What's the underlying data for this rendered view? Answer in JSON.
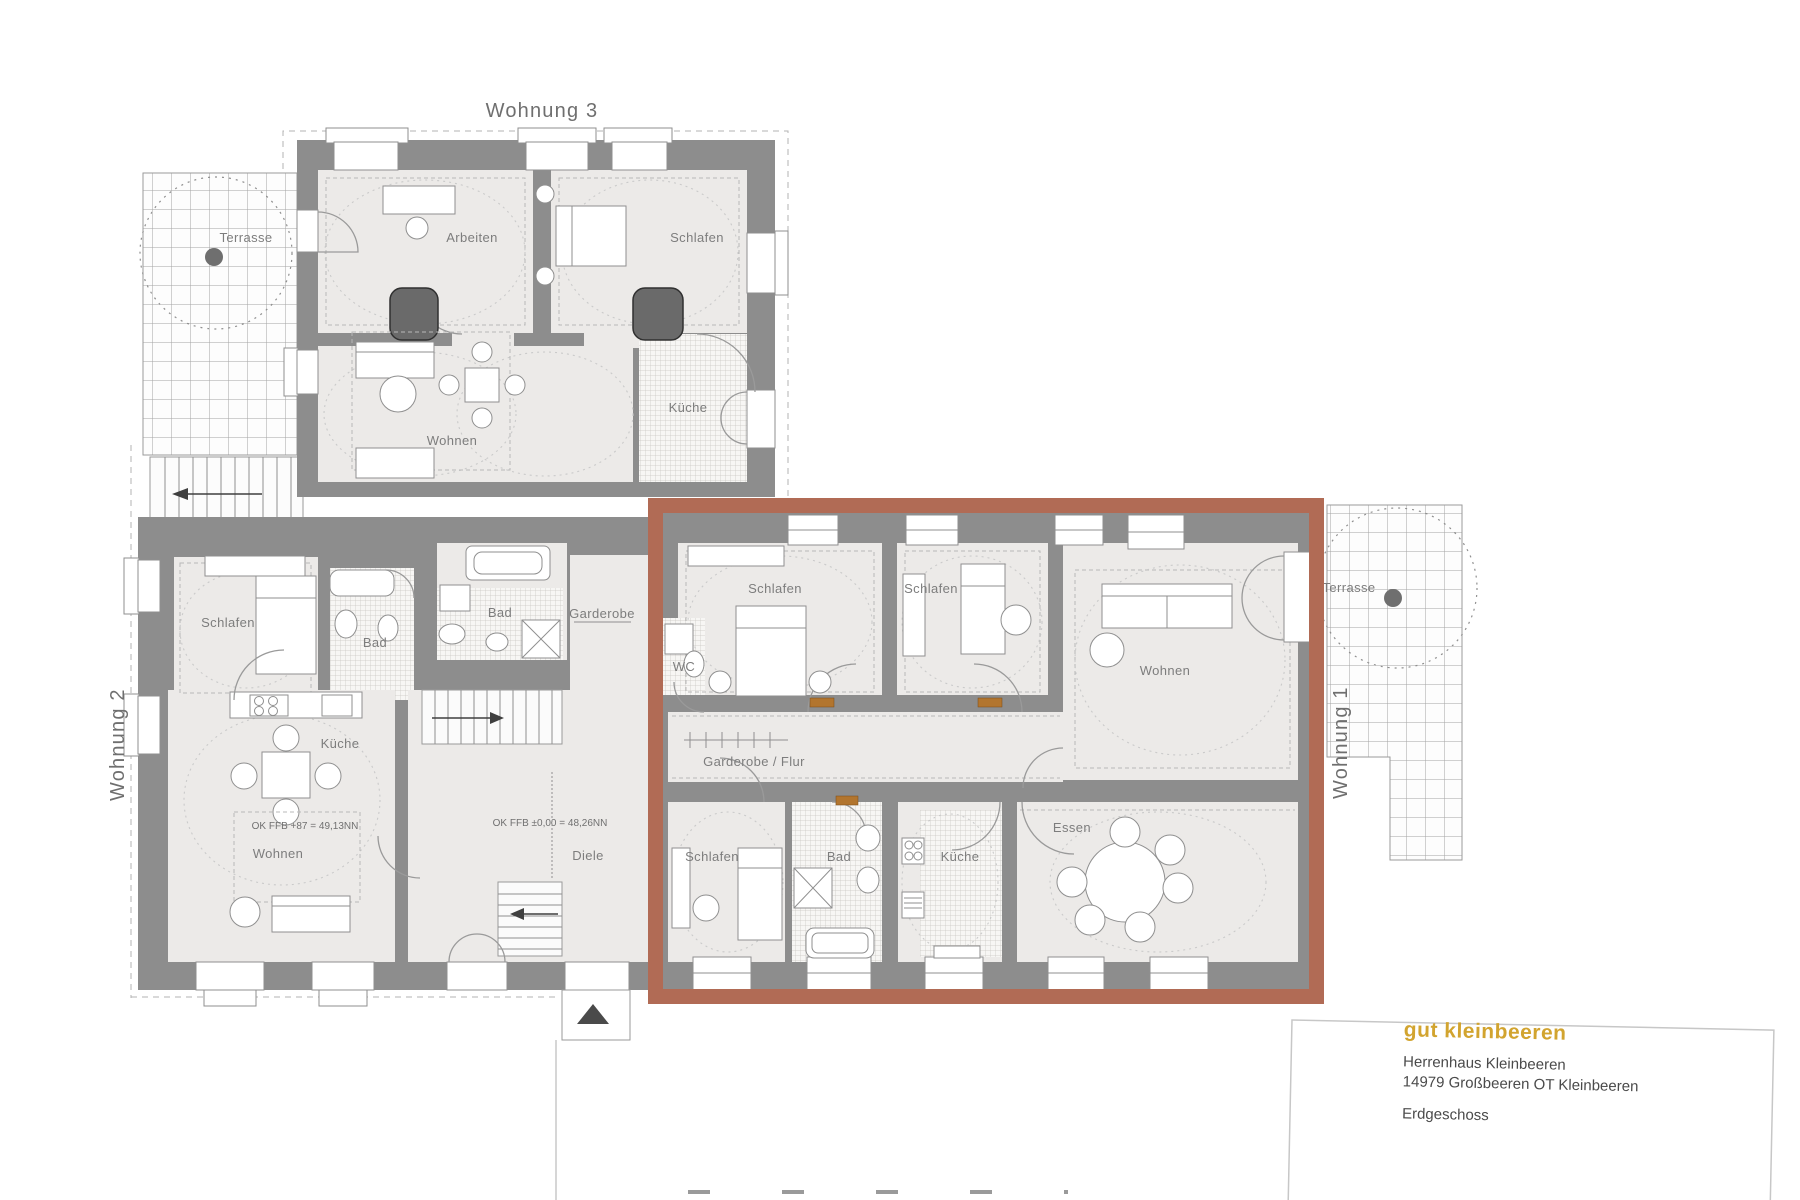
{
  "plan": {
    "apartment3": {
      "title": "Wohnung 3",
      "terrace_label": "Terrasse",
      "rooms": {
        "arbeiten": "Arbeiten",
        "schlafen": "Schlafen",
        "wohnen": "Wohnen",
        "kueche": "Küche"
      }
    },
    "apartment2": {
      "title": "Wohnung 2",
      "rooms": {
        "schlafen": "Schlafen",
        "bad1": "Bad",
        "bad2": "Bad",
        "garderobe": "Garderobe",
        "kueche": "Küche",
        "wohnen": "Wohnen"
      },
      "level_note": "OK FFB +87 = 49,13NN"
    },
    "hall": {
      "diele": "Diele",
      "level_note": "OK FFB ±0,00 = 48,26NN"
    },
    "apartment1": {
      "title": "Wohnung 1",
      "terrace_label": "Terrasse",
      "rooms": {
        "schlafen1": "Schlafen",
        "schlafen2": "Schlafen",
        "wohnen": "Wohnen",
        "wc": "WC",
        "flur": "Garderobe / Flur",
        "schlafen3": "Schlafen",
        "bad": "Bad",
        "kueche": "Küche",
        "essen": "Essen"
      }
    }
  },
  "title_block": {
    "brand": "gut kleinbeeren",
    "building": "Herrenhaus Kleinbeeren",
    "address": "14979 Großbeeren OT Kleinbeeren",
    "floor": "Erdgeschoss"
  },
  "colors": {
    "highlight": "#b16b55",
    "wall": "#8d8d8d",
    "accent_gold": "#d2a42f"
  }
}
